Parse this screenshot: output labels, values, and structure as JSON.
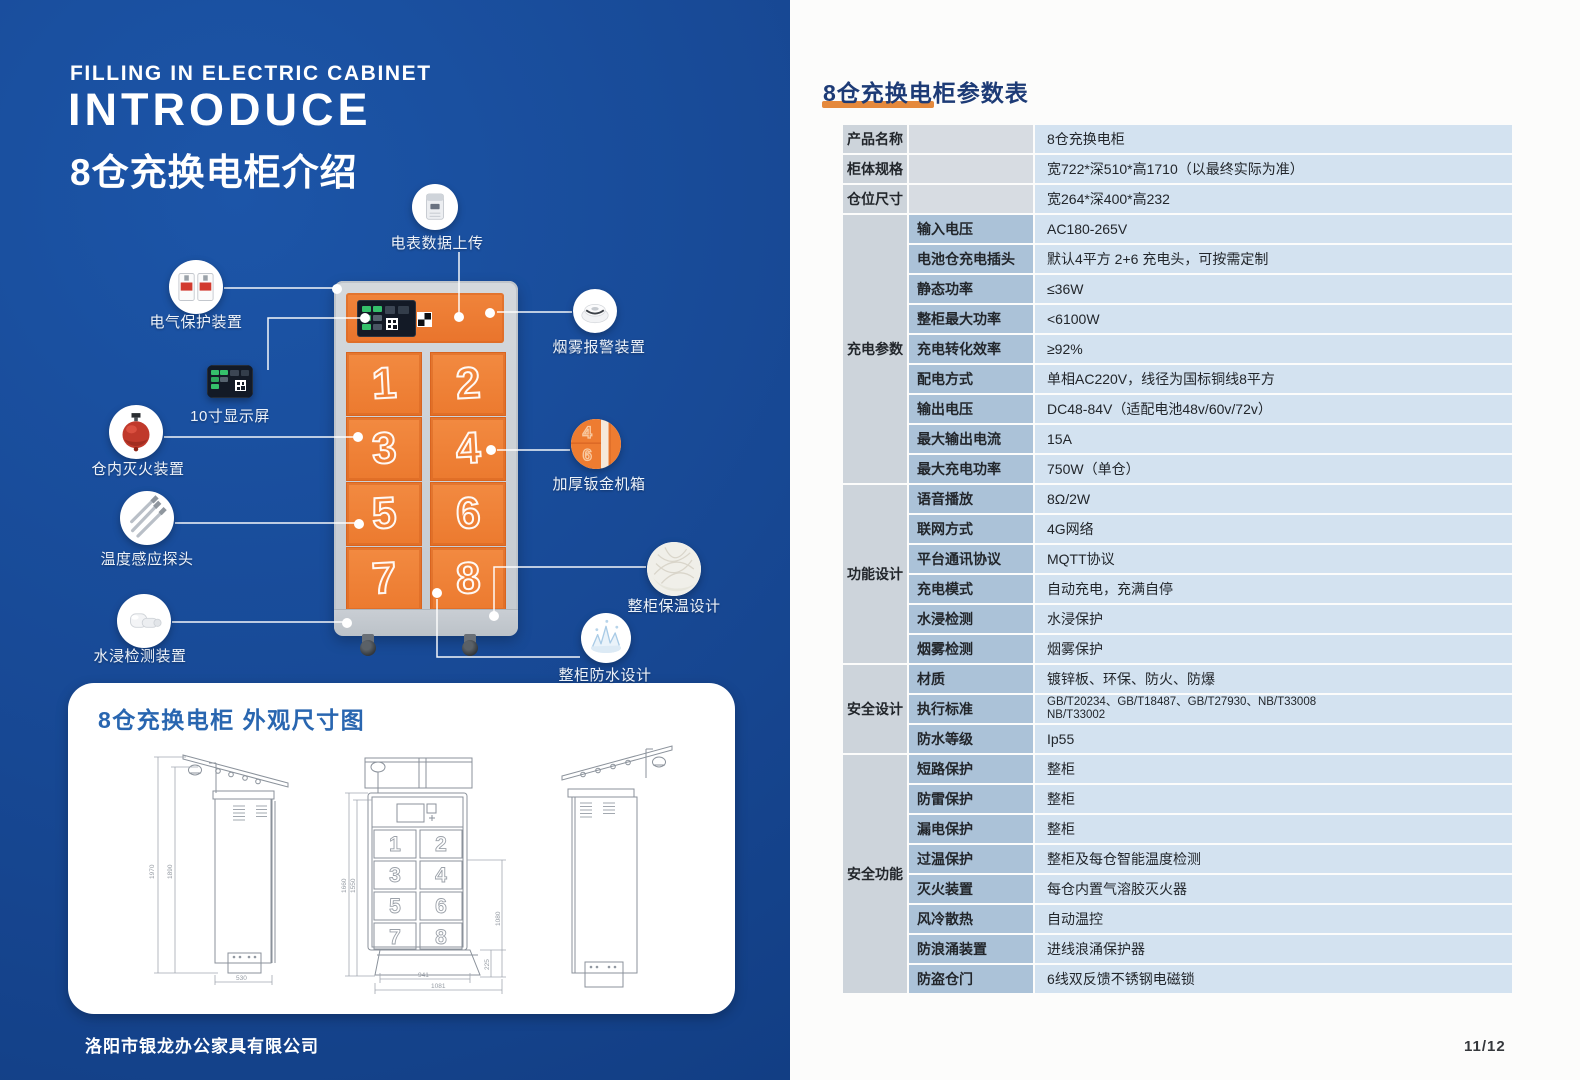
{
  "left_panel": {
    "subtitle_en": "FILLING IN ELECTRIC CABINET",
    "title_en": "INTRODUCE",
    "title_cn": "8仓充换电柜介绍",
    "company": "洛阳市银龙办公家具有限公司",
    "cabinet": {
      "door_numbers": [
        "1",
        "2",
        "3",
        "4",
        "5",
        "6",
        "7",
        "8"
      ]
    },
    "callouts": [
      {
        "id": "meter-upload",
        "label": "电表数据上传"
      },
      {
        "id": "electrical-protection",
        "label": "电气保护装置"
      },
      {
        "id": "display-screen",
        "label": "10寸显示屏"
      },
      {
        "id": "fire-extinguisher",
        "label": "仓内灭火装置"
      },
      {
        "id": "temperature-probe",
        "label": "温度感应探头"
      },
      {
        "id": "water-detection",
        "label": "水浸检测装置"
      },
      {
        "id": "smoke-alarm",
        "label": "烟雾报警装置"
      },
      {
        "id": "sheet-metal-case",
        "label": "加厚钣金机箱"
      },
      {
        "id": "insulation-design",
        "label": "整柜保温设计"
      },
      {
        "id": "waterproof-design",
        "label": "整柜防水设计"
      }
    ],
    "dimension_card": {
      "title": "8仓充换电柜 外观尺寸图",
      "dims": {
        "side_height_outer": "1970",
        "side_height_inner": "1890",
        "side_depth": "530",
        "front_height_outer": "1660",
        "front_height_inner": "1550",
        "front_right_height": "1080",
        "front_base_height": "225",
        "front_width_inner": "941",
        "front_width_outer": "1081"
      }
    }
  },
  "right_panel": {
    "title": "8仓充换电柜参数表",
    "page_number": "11/12",
    "table": {
      "sections": [
        {
          "group": "",
          "rows": [
            {
              "label": "产品名称",
              "value": "8仓充换电柜"
            },
            {
              "label": "柜体规格",
              "value": "宽722*深510*高1710（以最终实际为准）"
            },
            {
              "label": "仓位尺寸",
              "value": "宽264*深400*高232"
            }
          ]
        },
        {
          "group": "充电参数",
          "rows": [
            {
              "label": "输入电压",
              "value": "AC180-265V"
            },
            {
              "label": "电池仓充电插头",
              "value": "默认4平方 2+6 充电头，可按需定制"
            },
            {
              "label": "静态功率",
              "value": "≤36W"
            },
            {
              "label": "整柜最大功率",
              "value": "<6100W"
            },
            {
              "label": "充电转化效率",
              "value": "≥92%"
            },
            {
              "label": "配电方式",
              "value": "单相AC220V，线径为国标铜线8平方"
            },
            {
              "label": "输出电压",
              "value": "DC48-84V（适配电池48v/60v/72v）"
            },
            {
              "label": "最大输出电流",
              "value": "15A"
            },
            {
              "label": "最大充电功率",
              "value": "750W（单仓）"
            }
          ]
        },
        {
          "group": "功能设计",
          "rows": [
            {
              "label": "语音播放",
              "value": "8Ω/2W"
            },
            {
              "label": "联网方式",
              "value": "4G网络"
            },
            {
              "label": "平台通讯协议",
              "value": "MQTT协议"
            },
            {
              "label": "充电模式",
              "value": "自动充电，充满自停"
            },
            {
              "label": "水浸检测",
              "value": "水浸保护"
            },
            {
              "label": "烟雾检测",
              "value": "烟雾保护"
            }
          ]
        },
        {
          "group": "安全设计",
          "rows": [
            {
              "label": "材质",
              "value": "镀锌板、环保、防火、防爆"
            },
            {
              "label": "执行标准",
              "value": [
                "GB/T20234、GB/T18487、GB/T27930、NB/T33008",
                "NB/T33002"
              ],
              "small": true
            },
            {
              "label": "防水等级",
              "value": "Ip55"
            }
          ]
        },
        {
          "group": "安全功能",
          "rows": [
            {
              "label": "短路保护",
              "value": "整柜"
            },
            {
              "label": "防雷保护",
              "value": "整柜"
            },
            {
              "label": "漏电保护",
              "value": "整柜"
            },
            {
              "label": "过温保护",
              "value": "整柜及每仓智能温度检测"
            },
            {
              "label": "灭火装置",
              "value": "每仓内置气溶胶灭火器"
            },
            {
              "label": "风冷散热",
              "value": "自动温控"
            },
            {
              "label": "防浪涌装置",
              "value": "进线浪涌保护器"
            },
            {
              "label": "防盗仓门",
              "value": "6线双反馈不锈钢电磁锁"
            }
          ]
        }
      ]
    }
  },
  "colors": {
    "background_blue": "#16458f",
    "accent_orange": "#ee7c31",
    "table_title_navy": "#1d3b76",
    "title_underline_orange": "#e5893c",
    "table_label_blue": "#abc2d8",
    "table_value_blue": "#d3e2f0",
    "table_group_gray": "#cdd4db"
  }
}
